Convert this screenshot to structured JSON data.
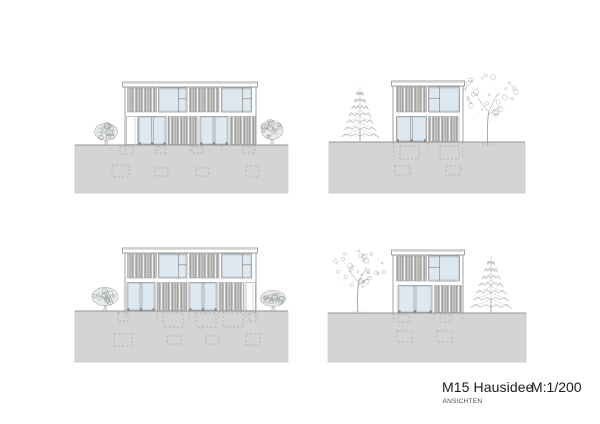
{
  "titleblock": {
    "title": "M15 Hausidee",
    "scale": "M:1/200",
    "subtitle": "ANSICHTEN"
  },
  "colors": {
    "background": "#ffffff",
    "ground": "#d4d4d4",
    "ground_edge": "#949494",
    "ground_border": "#c9c9c9",
    "line": "#8c8c8c",
    "window": "#dde8f1",
    "slat_base": "#c6c6c4",
    "slat_dark": "#8f8f8d",
    "slat_gap": "#f2f2f0",
    "foundation": "#9aa0a0",
    "tree": "#a0a6a2",
    "sill": "#777777"
  },
  "elevations": [
    {
      "id": "top-left",
      "ground": {
        "x": 75,
        "y": 145,
        "w": 213,
        "h": 48
      },
      "roof": {
        "x": 122.5,
        "y": 82,
        "w": 135,
        "h": 5
      },
      "facade": {
        "x": 125,
        "y": 87,
        "w": 131,
        "h": 58
      },
      "floors": [
        {
          "y": 88,
          "h": 24,
          "sections": [
            {
              "t": "slats",
              "x": 127.5,
              "w": 29
            },
            {
              "t": "winA",
              "x": 158.5,
              "w": 28.5
            },
            {
              "t": "slats",
              "x": 189.5,
              "w": 29.5
            },
            {
              "t": "winA",
              "x": 221.5,
              "w": 30
            }
          ]
        },
        {
          "y": 116.5,
          "h": 28,
          "sections": [
            {
              "t": "door",
              "x": 126.5,
              "w": 11
            },
            {
              "t": "winB",
              "x": 138.5,
              "w": 27.5
            },
            {
              "t": "slats",
              "x": 168,
              "w": 30
            },
            {
              "t": "winB",
              "x": 200,
              "w": 28
            },
            {
              "t": "slats",
              "x": 230,
              "w": 25.5
            }
          ]
        }
      ],
      "foundation": {
        "lines": [
          [
            125.5,
            145,
            125.5,
            150
          ],
          [
            255.5,
            145,
            255.5,
            150
          ],
          [
            158,
            145,
            158,
            151
          ],
          [
            190,
            145,
            190,
            151
          ],
          [
            222,
            145,
            222,
            151
          ]
        ],
        "rects": [
          [
            120,
            147,
            13,
            7
          ],
          [
            155,
            147,
            11,
            6
          ],
          [
            192,
            147,
            11,
            6
          ],
          [
            243,
            147,
            11,
            6
          ],
          [
            112,
            165,
            17,
            12
          ],
          [
            155,
            168,
            13,
            8
          ],
          [
            196,
            168,
            13,
            8
          ],
          [
            246,
            166,
            13,
            11
          ]
        ]
      },
      "trees": [
        {
          "type": "bush",
          "cx": 106,
          "base": 145,
          "w": 23,
          "h": 22,
          "seed": 3
        },
        {
          "type": "bush",
          "cx": 272,
          "base": 145,
          "w": 22,
          "h": 25,
          "seed": 11
        }
      ]
    },
    {
      "id": "top-right",
      "ground": {
        "x": 329,
        "y": 142,
        "w": 196,
        "h": 51
      },
      "roof": {
        "x": 391.5,
        "y": 81,
        "w": 73,
        "h": 5
      },
      "facade": {
        "x": 393,
        "y": 86,
        "w": 70,
        "h": 56
      },
      "floors": [
        {
          "y": 87,
          "h": 25,
          "sections": [
            {
              "t": "slats",
              "x": 396.5,
              "w": 30
            },
            {
              "t": "winC",
              "x": 428.5,
              "w": 31
            }
          ]
        },
        {
          "y": 116.5,
          "h": 25,
          "sections": [
            {
              "t": "winB",
              "x": 396.5,
              "w": 30
            },
            {
              "t": "slats",
              "x": 428.5,
              "w": 30.5
            }
          ]
        }
      ],
      "foundation": {
        "lines": [
          [
            393.5,
            142,
            393.5,
            157
          ],
          [
            462.5,
            142,
            462.5,
            157
          ],
          [
            427.5,
            142,
            427.5,
            150
          ]
        ],
        "rects": [
          [
            400,
            146,
            19,
            13
          ],
          [
            440,
            146,
            19,
            13
          ],
          [
            395,
            166,
            15,
            9
          ],
          [
            446,
            166,
            15,
            9
          ]
        ]
      },
      "trees": [
        {
          "type": "conifer",
          "cx": 360,
          "base": 142,
          "w": 38,
          "h": 55,
          "seed": 5
        },
        {
          "type": "deciduous",
          "cx": 488,
          "base": 146,
          "w": 60,
          "h": 76,
          "seed": 9
        }
      ]
    },
    {
      "id": "bottom-left",
      "ground": {
        "x": 75,
        "y": 311,
        "w": 213,
        "h": 51
      },
      "roof": {
        "x": 122.5,
        "y": 248,
        "w": 135,
        "h": 5
      },
      "facade": {
        "x": 125,
        "y": 253,
        "w": 131,
        "h": 58
      },
      "floors": [
        {
          "y": 254,
          "h": 24,
          "sections": [
            {
              "t": "slats",
              "x": 127.5,
              "w": 29
            },
            {
              "t": "winA",
              "x": 158.5,
              "w": 28.5
            },
            {
              "t": "slats",
              "x": 189.5,
              "w": 29.5
            },
            {
              "t": "winA",
              "x": 221.5,
              "w": 30
            }
          ]
        },
        {
          "y": 282.5,
          "h": 28,
          "sections": [
            {
              "t": "winB",
              "x": 127,
              "w": 28
            },
            {
              "t": "slats",
              "x": 157,
              "w": 30
            },
            {
              "t": "winB",
              "x": 189,
              "w": 28
            },
            {
              "t": "slats",
              "x": 219,
              "w": 25
            },
            {
              "t": "door",
              "x": 246,
              "w": 9.5
            }
          ]
        }
      ],
      "foundation": {
        "lines": [
          [
            125.5,
            311,
            125.5,
            319
          ],
          [
            255.5,
            311,
            255.5,
            319
          ],
          [
            157,
            311,
            157,
            318
          ],
          [
            189,
            311,
            189,
            318
          ],
          [
            219,
            311,
            219,
            318
          ],
          [
            246,
            311,
            246,
            318
          ]
        ],
        "rects": [
          [
            118,
            313,
            10,
            8
          ],
          [
            163,
            313,
            20,
            14
          ],
          [
            196,
            313,
            20,
            14
          ],
          [
            223,
            313,
            20,
            14
          ],
          [
            249,
            313,
            8,
            8
          ],
          [
            114,
            334,
            18,
            12
          ],
          [
            167,
            336,
            14,
            8
          ],
          [
            206,
            336,
            13,
            8
          ],
          [
            246,
            334,
            14,
            11
          ]
        ]
      },
      "trees": [
        {
          "type": "bush",
          "cx": 105,
          "base": 311,
          "w": 26,
          "h": 24,
          "seed": 17
        },
        {
          "type": "bush",
          "cx": 273,
          "base": 311,
          "w": 25,
          "h": 21,
          "seed": 23
        }
      ]
    },
    {
      "id": "bottom-right",
      "ground": {
        "x": 328,
        "y": 313,
        "w": 198,
        "h": 49
      },
      "roof": {
        "x": 391.5,
        "y": 250,
        "w": 73,
        "h": 5
      },
      "facade": {
        "x": 393,
        "y": 255,
        "w": 70,
        "h": 58
      },
      "floors": [
        {
          "y": 256,
          "h": 25,
          "sections": [
            {
              "t": "slats",
              "x": 396.5,
              "w": 30
            },
            {
              "t": "winC",
              "x": 428.5,
              "w": 31
            }
          ]
        },
        {
          "y": 285.5,
          "h": 27,
          "sections": [
            {
              "t": "winB",
              "x": 398,
              "w": 34
            },
            {
              "t": "slats",
              "x": 434.5,
              "w": 27
            }
          ]
        }
      ],
      "foundation": {
        "lines": [
          [
            393.5,
            313,
            393.5,
            322
          ],
          [
            462.5,
            313,
            462.5,
            322
          ],
          [
            434,
            313,
            434,
            319
          ]
        ],
        "rects": [
          [
            398,
            315,
            12,
            7
          ],
          [
            440,
            315,
            12,
            7
          ],
          [
            397,
            331,
            15,
            11
          ],
          [
            437,
            331,
            15,
            11
          ]
        ]
      },
      "trees": [
        {
          "type": "deciduous",
          "cx": 358,
          "base": 313,
          "w": 56,
          "h": 68,
          "seed": 29
        },
        {
          "type": "conifer",
          "cx": 491,
          "base": 313,
          "w": 42,
          "h": 57,
          "seed": 31
        }
      ]
    }
  ]
}
